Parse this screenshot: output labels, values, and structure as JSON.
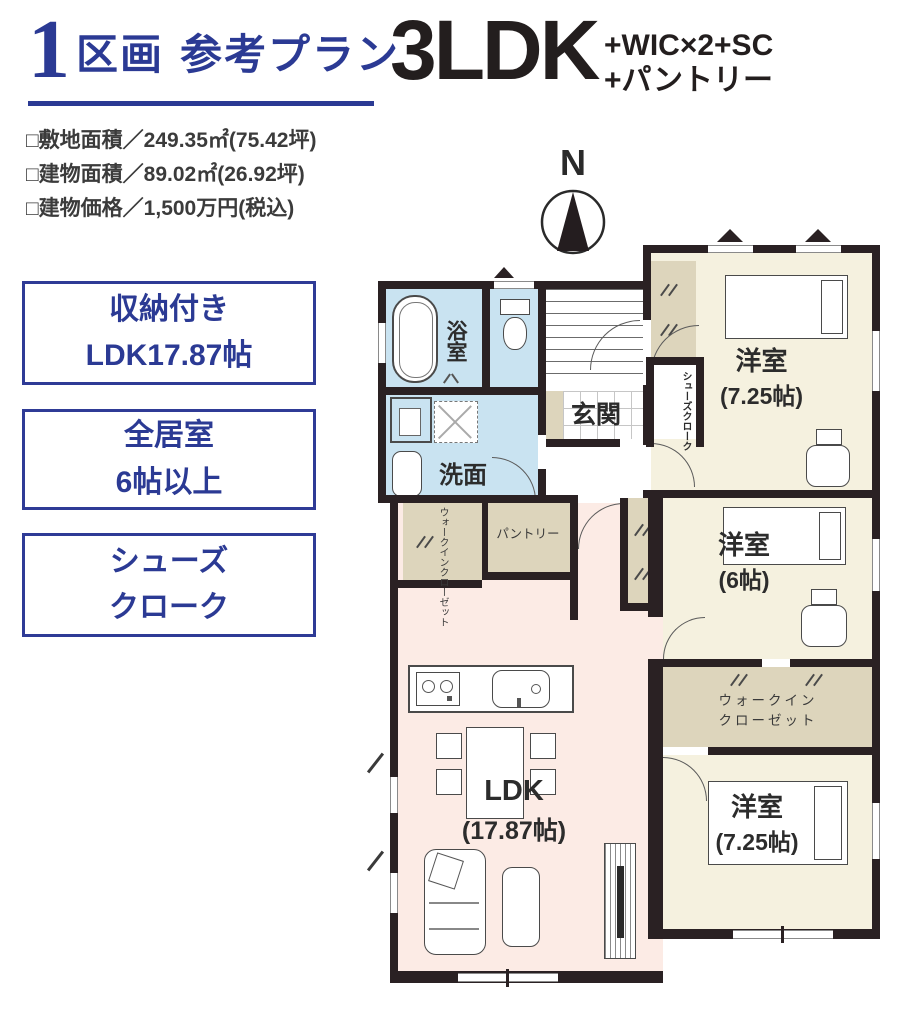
{
  "title": {
    "number": "1",
    "unit": "区画",
    "plan": "参考プラン"
  },
  "layout": {
    "main": "3LDK",
    "extra1": "+WIC×2+SC",
    "extra2": "+パントリー"
  },
  "details": [
    "□敷地面積／249.35㎡(75.42坪)",
    "□建物面積／89.02㎡(26.92坪)",
    "□建物価格／1,500万円(税込)"
  ],
  "features": [
    {
      "line1": "収納付き",
      "line2": "LDK17.87帖"
    },
    {
      "line1": "全居室",
      "line2": "6帖以上"
    },
    {
      "line1": "シューズ",
      "line2": "クローク"
    }
  ],
  "compass": {
    "north": "N"
  },
  "plan": {
    "bath": "浴室",
    "washroom": "洗面",
    "entrance": "玄関",
    "shoes_closet": "シューズクローク",
    "bedroom_ne": {
      "name": "洋室",
      "size": "(7.25帖)"
    },
    "bedroom_e": {
      "name": "洋室",
      "size": "(6帖)"
    },
    "bedroom_se": {
      "name": "洋室",
      "size": "(7.25帖)"
    },
    "ldk": {
      "name": "LDK",
      "size": "(17.87帖)"
    },
    "pantry": "パントリー",
    "wic_side": "ウォークインクローゼット",
    "wic_east": {
      "line1": "ウォークイン",
      "line2": "クローゼット"
    }
  },
  "colors": {
    "accent": "#2b3a94",
    "wall": "#2a2123",
    "wet_area": "#c9e3f1",
    "room_cream": "#f5f1df",
    "closet_tan": "#ddd5bc",
    "ldk_pink": "#fcebe5"
  }
}
